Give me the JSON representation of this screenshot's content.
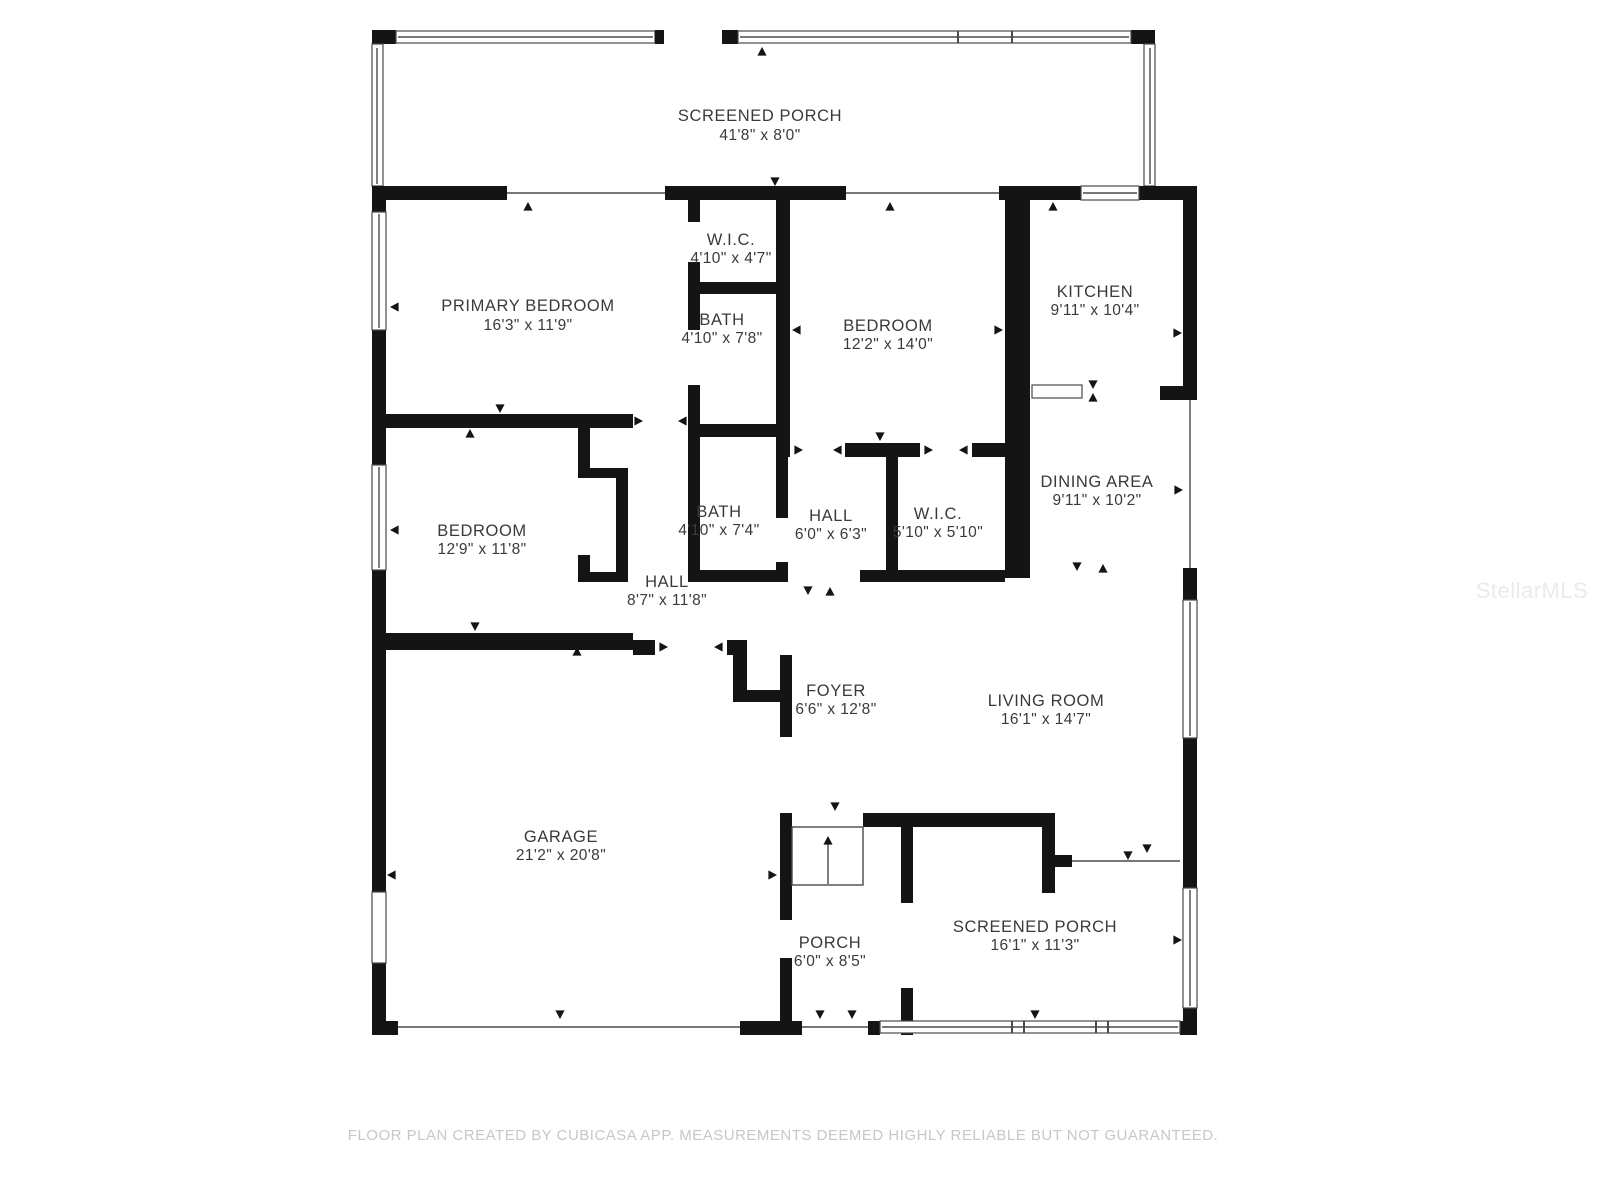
{
  "colors": {
    "wall": "#141414",
    "line": "#4a4a4a",
    "label": "#3a3a3a",
    "footer": "#c7c7c7",
    "wm": "#eaeaea",
    "bg": "#ffffff"
  },
  "rooms": [
    {
      "id": "screened-porch-top",
      "name": "SCREENED PORCH",
      "dims": "41'8\" x 8'0\""
    },
    {
      "id": "primary-bedroom",
      "name": "PRIMARY BEDROOM",
      "dims": "16'3\" x 11'9\""
    },
    {
      "id": "wic-top",
      "name": "W.I.C.",
      "dims": "4'10\" x 4'7\""
    },
    {
      "id": "bath-top",
      "name": "BATH",
      "dims": "4'10\" x 7'8\""
    },
    {
      "id": "bedroom-right",
      "name": "BEDROOM",
      "dims": "12'2\" x 14'0\""
    },
    {
      "id": "kitchen",
      "name": "KITCHEN",
      "dims": "9'11\" x 10'4\""
    },
    {
      "id": "dining-area",
      "name": "DINING AREA",
      "dims": "9'11\" x 10'2\""
    },
    {
      "id": "bedroom-left",
      "name": "BEDROOM",
      "dims": "12'9\" x 11'8\""
    },
    {
      "id": "bath-mid",
      "name": "BATH",
      "dims": "4'10\" x 7'4\""
    },
    {
      "id": "hall-small",
      "name": "HALL",
      "dims": "6'0\" x 6'3\""
    },
    {
      "id": "wic-mid",
      "name": "W.I.C.",
      "dims": "5'10\" x 5'10\""
    },
    {
      "id": "hall-large",
      "name": "HALL",
      "dims": "8'7\" x 11'8\""
    },
    {
      "id": "foyer",
      "name": "FOYER",
      "dims": "6'6\" x 12'8\""
    },
    {
      "id": "living-room",
      "name": "LIVING ROOM",
      "dims": "16'1\" x 14'7\""
    },
    {
      "id": "garage",
      "name": "GARAGE",
      "dims": "21'2\" x 20'8\""
    },
    {
      "id": "porch",
      "name": "PORCH",
      "dims": "6'0\" x 8'5\""
    },
    {
      "id": "screened-porch-bottom",
      "name": "SCREENED PORCH",
      "dims": "16'1\" x 11'3\""
    }
  ],
  "footer": {
    "disclaimer": "FLOOR PLAN CREATED BY CUBICASA APP. MEASUREMENTS DEEMED HIGHLY RELIABLE BUT NOT GUARANTEED."
  },
  "watermark": {
    "text": "StellarMLS"
  }
}
